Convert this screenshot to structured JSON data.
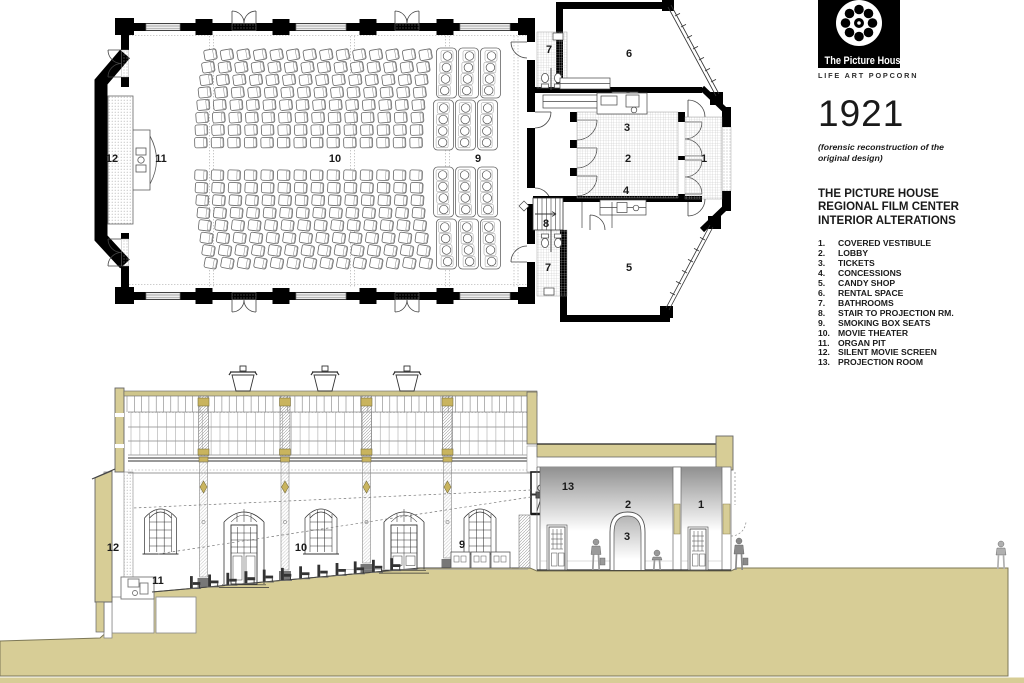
{
  "branding": {
    "logo_title": "The Picture House",
    "logo_tagline": "LIFE ART POPCORN",
    "year": "1921",
    "subtitle": "(forensic reconstruction of the original design)"
  },
  "header": {
    "line1": "THE PICTURE HOUSE",
    "line2": "REGIONAL FILM CENTER",
    "line3": "INTERIOR ALTERATIONS"
  },
  "legend": {
    "items": [
      {
        "num": "1.",
        "label": "COVERED VESTIBULE"
      },
      {
        "num": "2.",
        "label": "LOBBY"
      },
      {
        "num": "3.",
        "label": "TICKETS"
      },
      {
        "num": "4.",
        "label": "CONCESSIONS"
      },
      {
        "num": "5.",
        "label": "CANDY SHOP"
      },
      {
        "num": "6.",
        "label": "RENTAL SPACE"
      },
      {
        "num": "7.",
        "label": "BATHROOMS"
      },
      {
        "num": "8.",
        "label": "STAIR TO PROJECTION RM."
      },
      {
        "num": "9.",
        "label": "SMOKING BOX SEATS"
      },
      {
        "num": "10.",
        "label": "MOVIE THEATER"
      },
      {
        "num": "11.",
        "label": "ORGAN PIT"
      },
      {
        "num": "12.",
        "label": "SILENT MOVIE SCREEN"
      },
      {
        "num": "13.",
        "label": "PROJECTION ROOM"
      }
    ]
  },
  "plan": {
    "labels": [
      {
        "t": "12",
        "x": 112,
        "y": 162
      },
      {
        "t": "11",
        "x": 161,
        "y": 162
      },
      {
        "t": "10",
        "x": 335,
        "y": 162
      },
      {
        "t": "9",
        "x": 478,
        "y": 162
      },
      {
        "t": "7",
        "x": 549,
        "y": 53
      },
      {
        "t": "6",
        "x": 629,
        "y": 57
      },
      {
        "t": "3",
        "x": 627,
        "y": 131
      },
      {
        "t": "2",
        "x": 628,
        "y": 162
      },
      {
        "t": "1",
        "x": 704,
        "y": 162
      },
      {
        "t": "4",
        "x": 626,
        "y": 194
      },
      {
        "t": "8",
        "x": 546,
        "y": 227
      },
      {
        "t": "7",
        "x": 548,
        "y": 271
      },
      {
        "t": "5",
        "x": 629,
        "y": 271
      }
    ]
  },
  "section": {
    "labels": [
      {
        "t": "12",
        "x": 113,
        "y": 551
      },
      {
        "t": "11",
        "x": 158,
        "y": 584
      },
      {
        "t": "10",
        "x": 301,
        "y": 551
      },
      {
        "t": "9",
        "x": 462,
        "y": 548
      },
      {
        "t": "13",
        "x": 568,
        "y": 490
      },
      {
        "t": "2",
        "x": 628,
        "y": 508
      },
      {
        "t": "3",
        "x": 627,
        "y": 540
      },
      {
        "t": "1",
        "x": 701,
        "y": 508
      }
    ]
  },
  "colors": {
    "ground_tan": "#d7cd96",
    "roof_tan": "#cfc68c",
    "capital_gold": "#c9b45e",
    "ink": "#1a1a1a"
  }
}
